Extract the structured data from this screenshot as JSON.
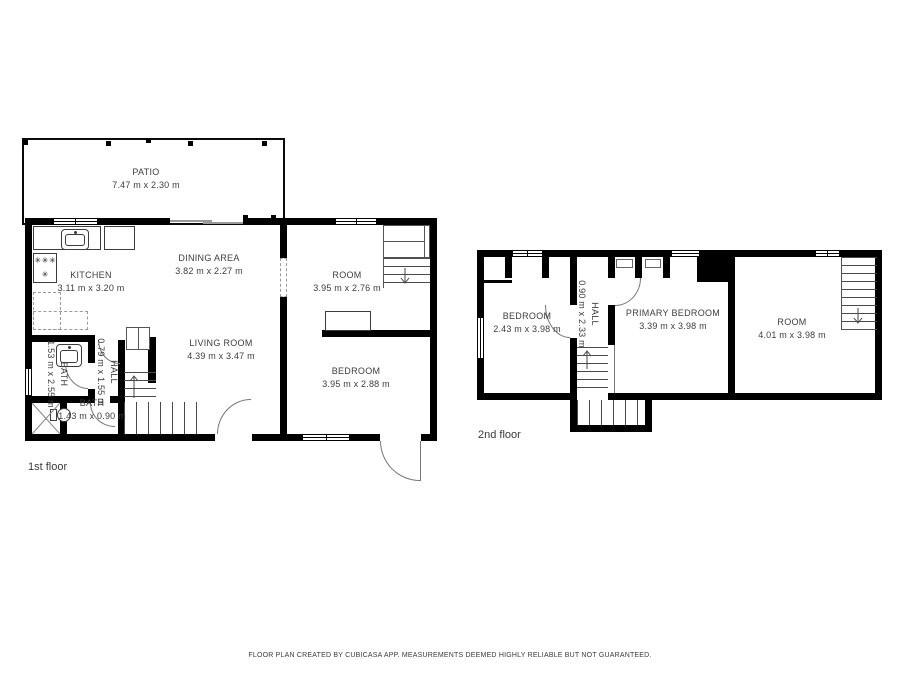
{
  "title": "Floor plan",
  "floors": [
    {
      "label": "1st floor",
      "rooms": [
        {
          "name": "PATIO",
          "dims": "7.47 m x 2.30 m"
        },
        {
          "name": "KITCHEN",
          "dims": "3.11 m x 3.20 m"
        },
        {
          "name": "DINING AREA",
          "dims": "3.82 m x 2.27 m"
        },
        {
          "name": "ROOM",
          "dims": "3.95 m x 2.76 m"
        },
        {
          "name": "LIVING ROOM",
          "dims": "4.39 m x 3.47 m"
        },
        {
          "name": "BEDROOM",
          "dims": "3.95 m x 2.88 m"
        },
        {
          "name": "BATH",
          "dims": "1.53 m x 2.55 m"
        },
        {
          "name": "HALL",
          "dims": "0.79 m x 1.55 m"
        },
        {
          "name": "BATH",
          "dims": "1.43 m x 0.90 m"
        }
      ]
    },
    {
      "label": "2nd floor",
      "rooms": [
        {
          "name": "BEDROOM",
          "dims": "2.43 m x 3.98 m"
        },
        {
          "name": "HALL",
          "dims": "0.90 m x 2.33 m"
        },
        {
          "name": "PRIMARY BEDROOM",
          "dims": "3.39 m x 3.98 m"
        },
        {
          "name": "ROOM",
          "dims": "4.01 m x 3.98 m"
        }
      ]
    }
  ],
  "footer": "FLOOR PLAN CREATED BY CUBICASA APP. MEASUREMENTS DEEMED HIGHLY RELIABLE BUT NOT GUARANTEED.",
  "colors": {
    "wall": "#000000",
    "text": "#3d3d3d",
    "background": "#ffffff",
    "door_line": "#777777"
  }
}
